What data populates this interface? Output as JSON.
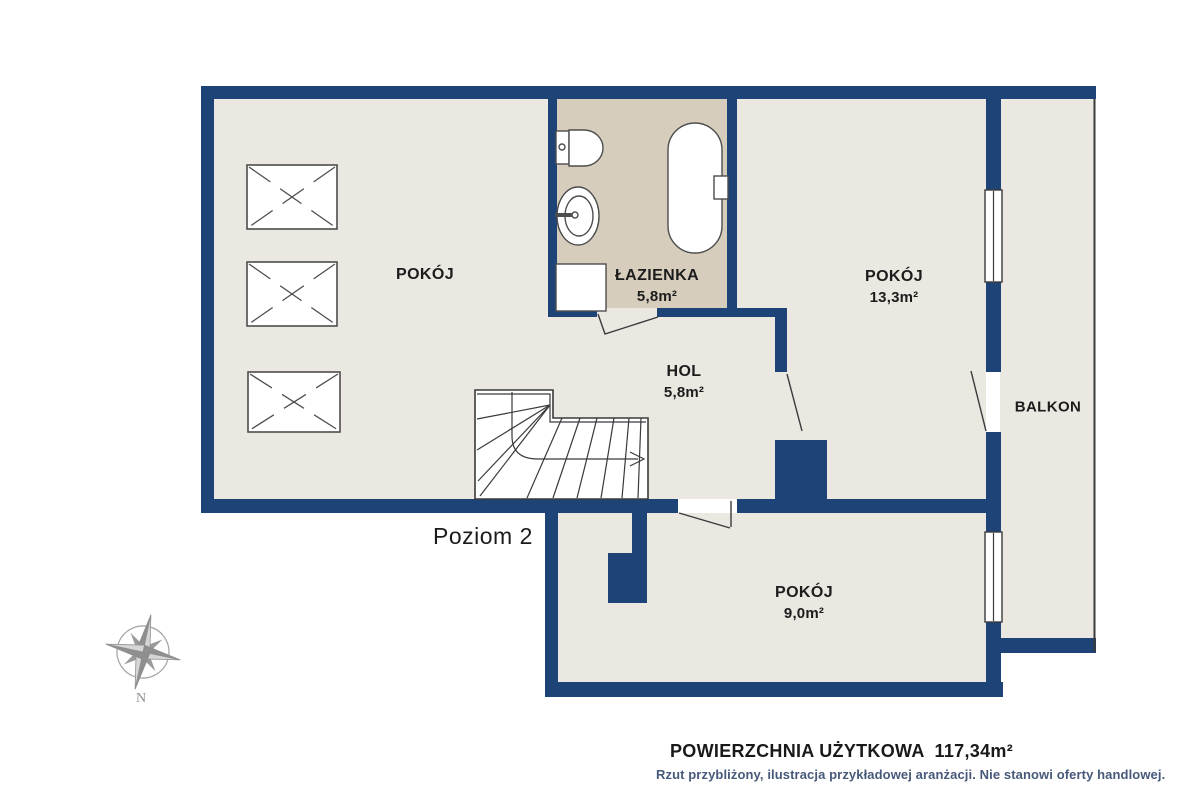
{
  "plan": {
    "level_label": "Poziom 2",
    "rooms": [
      {
        "name": "POKÓJ",
        "area": ""
      },
      {
        "name": "ŁAZIENKA",
        "area": "5,8m²"
      },
      {
        "name": "HOL",
        "area": "5,8m²"
      },
      {
        "name": "POKÓJ",
        "area": "13,3m²"
      },
      {
        "name": "BALKON",
        "area": ""
      },
      {
        "name": "POKÓJ",
        "area": "9,0m²"
      }
    ],
    "compass": {
      "north_label": "N"
    }
  },
  "footer": {
    "title": "POWIERZCHNIA UŻYTKOWA  117,34m²",
    "disclaimer": "Rzut przybliżony, ilustracja przykładowej aranżacji. Nie stanowi oferty handlowej."
  },
  "colors": {
    "wall": "#1e4377",
    "floor": "#ebe8e1",
    "bathroom_floor": "#d6cdbd",
    "accent_text": "#47597a"
  }
}
